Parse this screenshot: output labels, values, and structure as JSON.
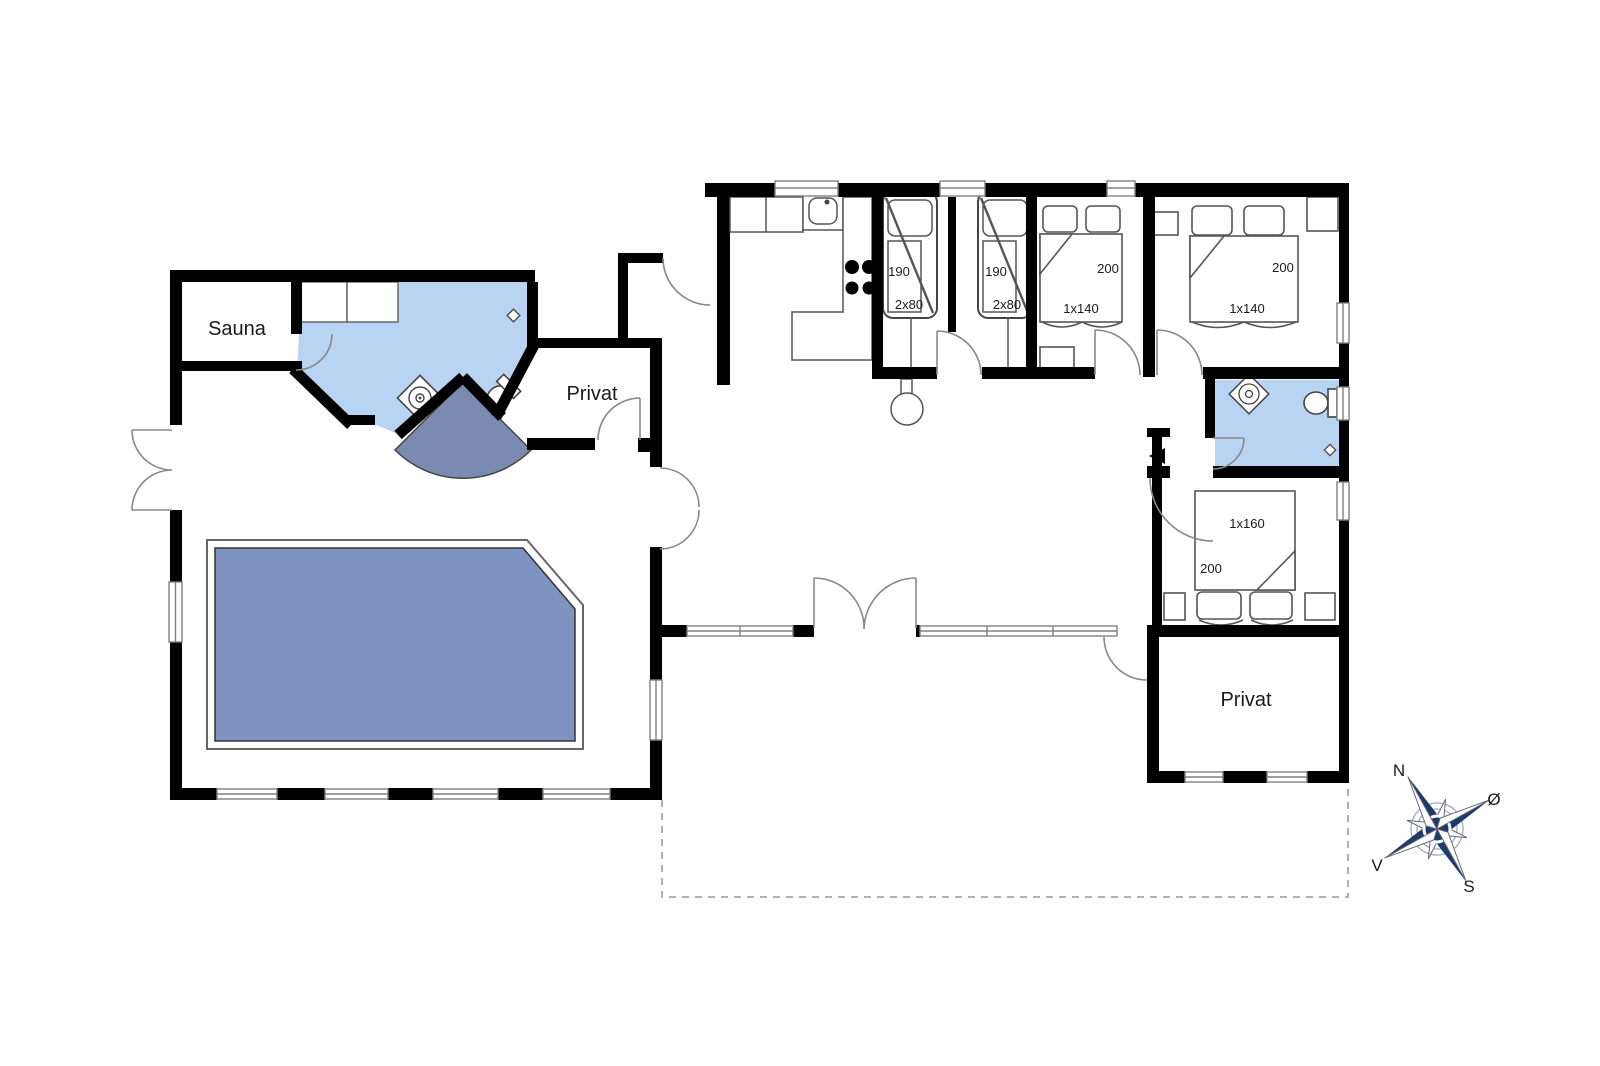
{
  "plan": {
    "rooms": {
      "sauna": "Sauna",
      "privat_pool": "Privat",
      "privat_main": "Privat"
    },
    "beds": {
      "bunk_left": {
        "length": "190",
        "size": "2x80"
      },
      "bunk_right": {
        "length": "190",
        "size": "2x80"
      },
      "double_mid": {
        "length": "200",
        "size": "1x140"
      },
      "double_right": {
        "length": "200",
        "size": "1x140"
      },
      "double_south": {
        "size": "1x160",
        "length": "200"
      }
    },
    "compass": {
      "north": "N",
      "east": "Ø",
      "south": "S",
      "west": "V"
    },
    "colors": {
      "wall": "#000000",
      "bath_floor": "#b9d4f2",
      "pool_water": "#7e93c0",
      "shower_floor": "#7b8ab0",
      "compass_navy": "#1c3a6a"
    }
  }
}
